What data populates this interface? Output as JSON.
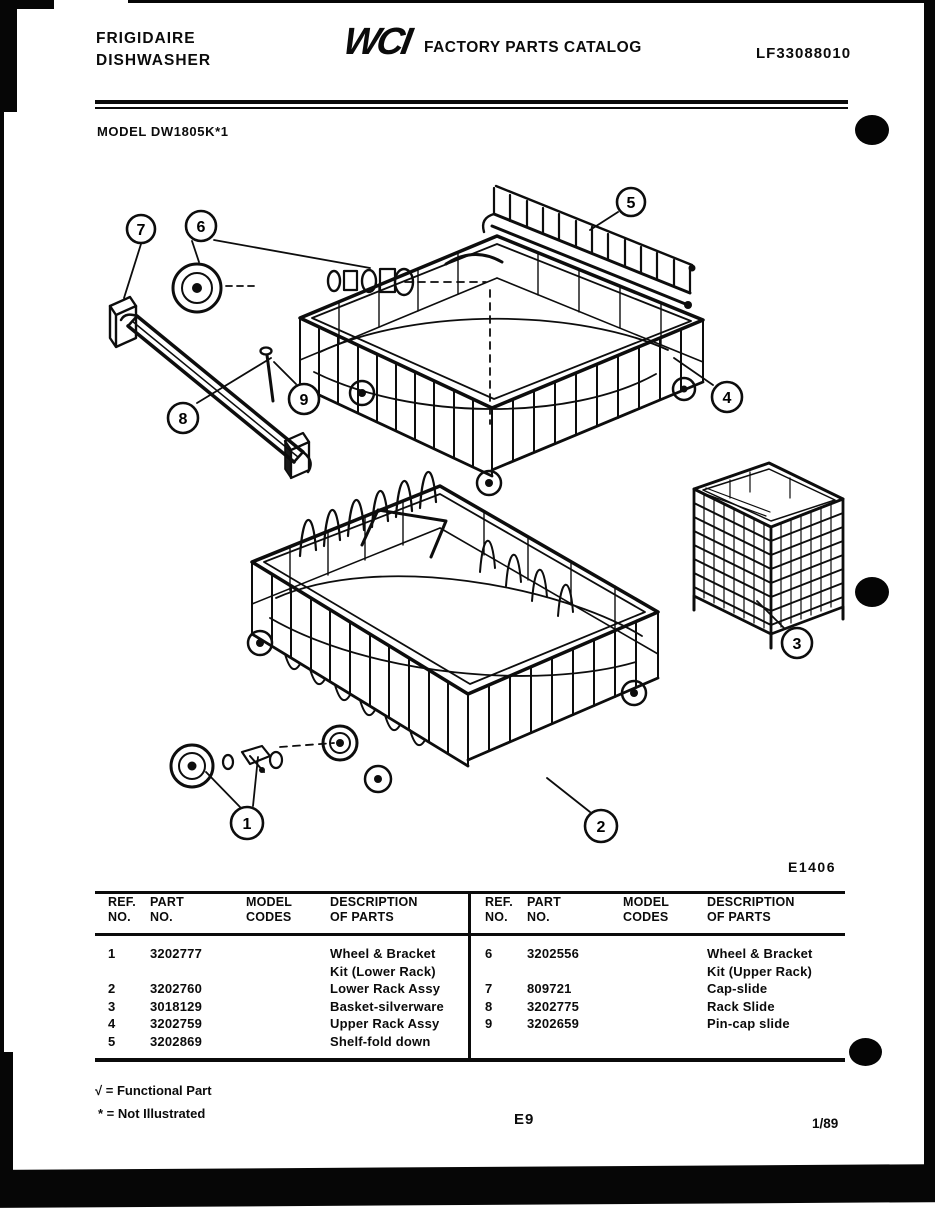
{
  "page": {
    "paper_color": "#ffffff",
    "ink_color": "#0b0b0b"
  },
  "header": {
    "brand_line1": "FRIGIDAIRE",
    "brand_line2": "DISHWASHER",
    "logo_text": "WCI",
    "catalog_title": "FACTORY PARTS CATALOG",
    "document_number": "LF33088010",
    "model_line": "MODEL DW1805K*1"
  },
  "diagram": {
    "figure_code": "E1406",
    "callouts": [
      "1",
      "2",
      "3",
      "4",
      "5",
      "6",
      "7",
      "8",
      "9"
    ]
  },
  "parts_table": {
    "headers": [
      {
        "line1": "REF.",
        "line2": "NO."
      },
      {
        "line1": "PART",
        "line2": "NO."
      },
      {
        "line1": "MODEL",
        "line2": "CODES"
      },
      {
        "line1": "DESCRIPTION",
        "line2": "OF PARTS"
      }
    ],
    "left_rows": [
      {
        "ref": "1",
        "part": "3202777",
        "codes": "",
        "desc_lines": [
          "Wheel & Bracket",
          "Kit (Lower Rack)"
        ]
      },
      {
        "ref": "2",
        "part": "3202760",
        "codes": "",
        "desc_lines": [
          "Lower Rack Assy"
        ]
      },
      {
        "ref": "3",
        "part": "3018129",
        "codes": "",
        "desc_lines": [
          "Basket-silverware"
        ]
      },
      {
        "ref": "4",
        "part": "3202759",
        "codes": "",
        "desc_lines": [
          "Upper Rack Assy"
        ]
      },
      {
        "ref": "5",
        "part": "3202869",
        "codes": "",
        "desc_lines": [
          "Shelf-fold down"
        ]
      }
    ],
    "right_rows": [
      {
        "ref": "6",
        "part": "3202556",
        "codes": "",
        "desc_lines": [
          "Wheel & Bracket",
          "Kit (Upper Rack)"
        ]
      },
      {
        "ref": "7",
        "part": "809721",
        "codes": "",
        "desc_lines": [
          "Cap-slide"
        ]
      },
      {
        "ref": "8",
        "part": "3202775",
        "codes": "",
        "desc_lines": [
          "Rack Slide"
        ]
      },
      {
        "ref": "9",
        "part": "3202659",
        "codes": "",
        "desc_lines": [
          "Pin-cap slide"
        ]
      }
    ]
  },
  "footer": {
    "legend_functional": "√ = Functional Part",
    "legend_not_illustrated": "* = Not Illustrated",
    "page_code": "E9",
    "date_code": "1/89"
  }
}
